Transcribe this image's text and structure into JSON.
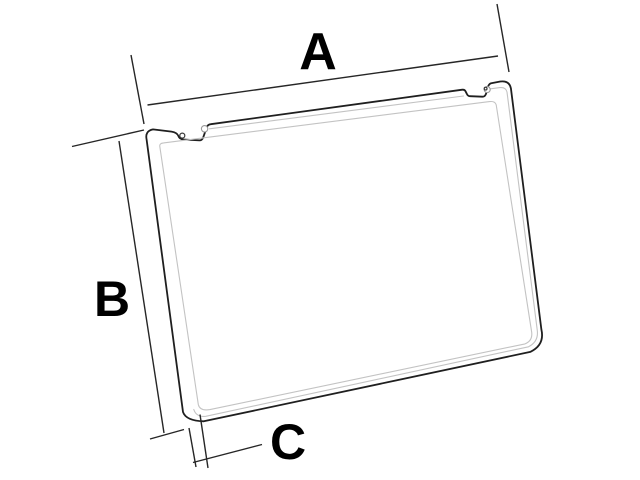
{
  "diagram": {
    "kind": "technical-dimension-diagram",
    "subject": "notched rectangular frame panel shown in perspective",
    "labels": {
      "a": "A",
      "b": "B",
      "c": "C"
    },
    "colors": {
      "background": "#ffffff",
      "outline": "#1f1f1f",
      "inner_line": "#c3c3c3",
      "dimension_line": "#262626",
      "label": "#000000"
    }
  }
}
